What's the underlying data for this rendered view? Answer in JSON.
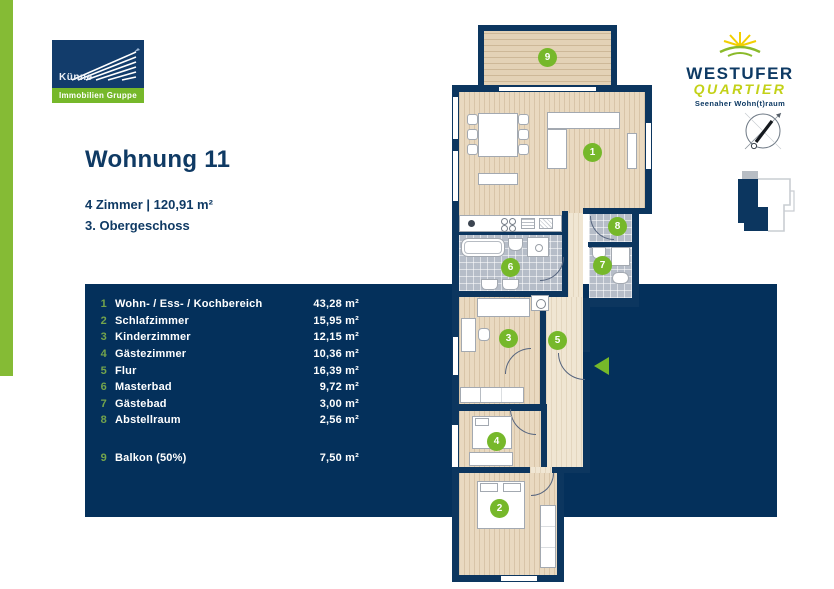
{
  "brand": {
    "kunne": {
      "name": "Künne",
      "sub": "Immobilien Gruppe"
    },
    "westufer": {
      "line1": "WESTUFER",
      "line2": "QUARTIER",
      "tagline": "Seenaher Wohn(t)raum"
    }
  },
  "header": {
    "title": "Wohnung 11",
    "details": "4 Zimmer | 120,91 m²",
    "floor": "3. Obergeschoss"
  },
  "rooms": [
    {
      "no": "1",
      "name": "Wohn- / Ess- / Kochbereich",
      "area": "43,28 m²"
    },
    {
      "no": "2",
      "name": "Schlafzimmer",
      "area": "15,95 m²"
    },
    {
      "no": "3",
      "name": "Kinderzimmer",
      "area": "12,15 m²"
    },
    {
      "no": "4",
      "name": "Gästezimmer",
      "area": "10,36 m²"
    },
    {
      "no": "5",
      "name": "Flur",
      "area": "16,39 m²"
    },
    {
      "no": "6",
      "name": "Masterbad",
      "area": "9,72 m²"
    },
    {
      "no": "7",
      "name": "Gästebad",
      "area": "3,00 m²"
    },
    {
      "no": "8",
      "name": "Abstellraum",
      "area": "2,56 m²"
    },
    {
      "no": "9",
      "name": "Balkon (50%)",
      "area": "7,50 m²"
    }
  ],
  "plan": {
    "markers": [
      "1",
      "2",
      "3",
      "4",
      "5",
      "6",
      "7",
      "8",
      "9"
    ]
  },
  "colors": {
    "accent_green": "#76b82a",
    "panel_navy": "#04305b",
    "wall_navy": "#0c365f",
    "floor_beige": "#e9d9c0",
    "tile_gray": "#b6bdc8"
  }
}
